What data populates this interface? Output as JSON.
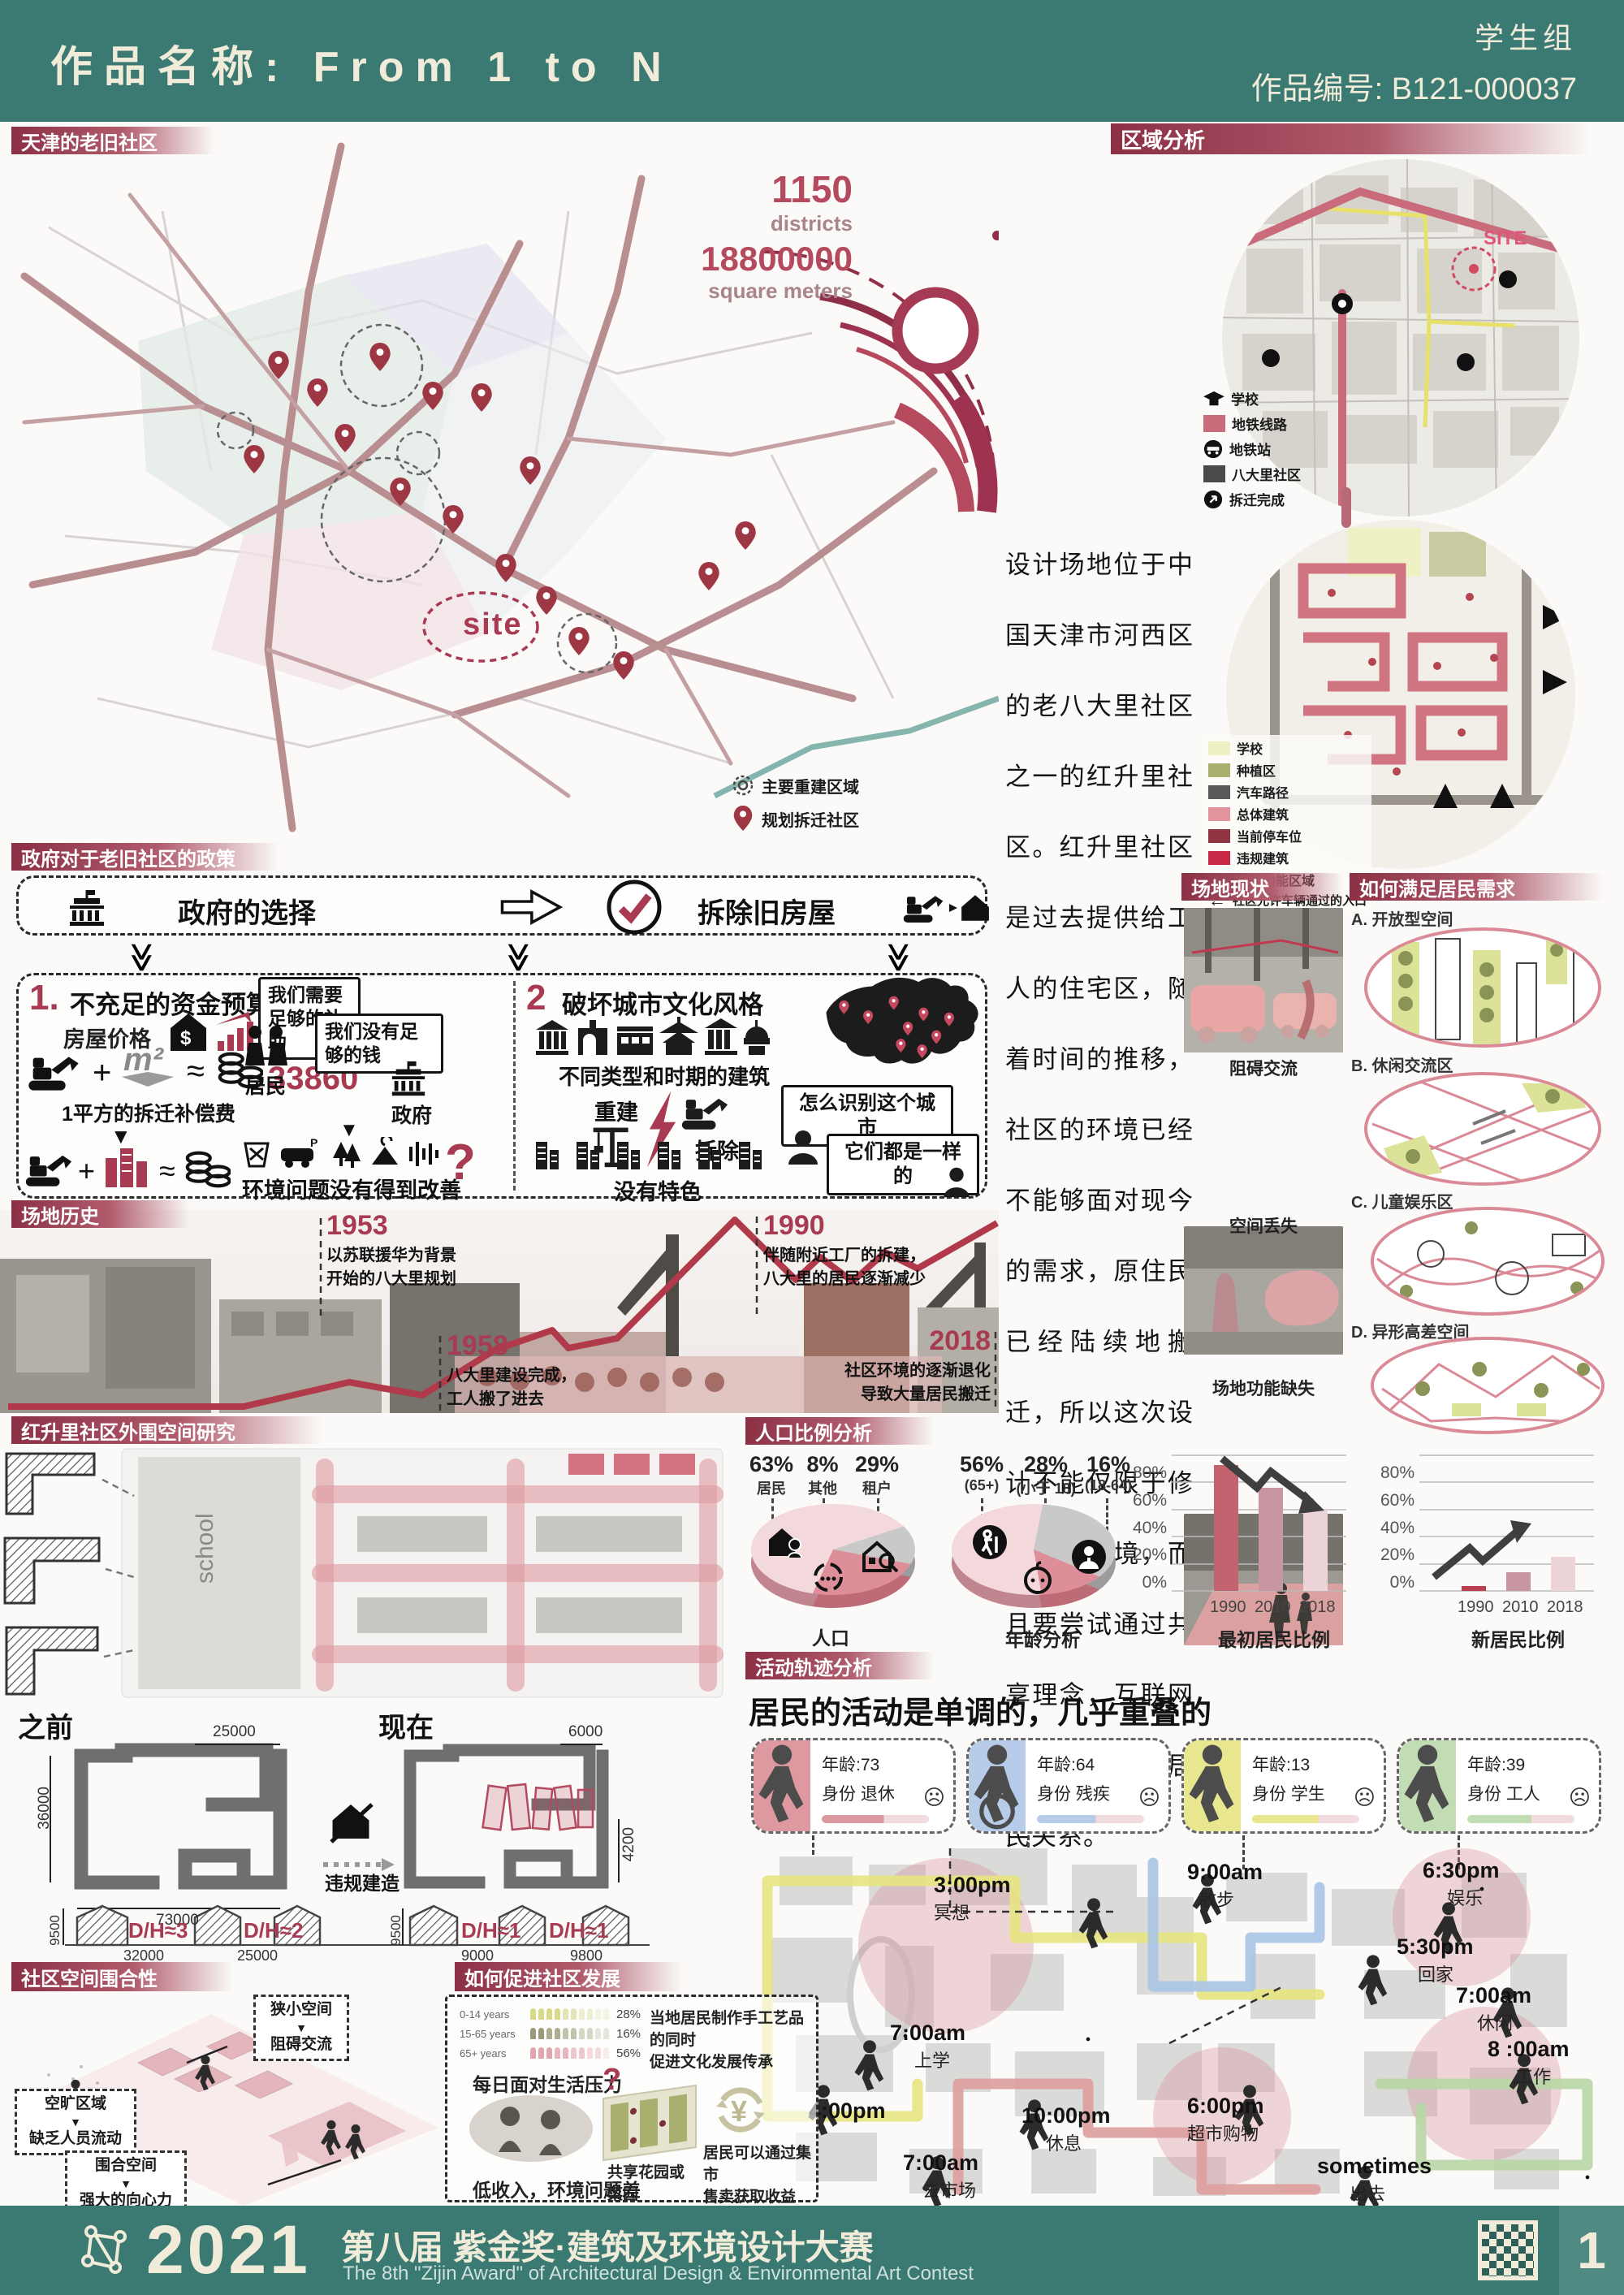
{
  "header": {
    "title": "作品名称: From 1 to N",
    "group": "学生组",
    "work_no": "作品编号: B121-000037"
  },
  "colors": {
    "teal": "#3a7a72",
    "maroon": "#a83a52",
    "accent_red": "#b5495e",
    "pink_light": "#e8c9ce"
  },
  "icons": {
    "down_triangle": "▼",
    "double_chevron": "≫",
    "sad_face": "☹",
    "left_arrow": "←",
    "tri_right": "▸"
  },
  "old_community": {
    "label": "天津的老旧社区",
    "stat1_value": "1150",
    "stat1_unit": "districts",
    "stat2_value": "18800000",
    "stat2_unit": "square meters",
    "base": "BASE",
    "site": "site",
    "legend": [
      {
        "label": "主要重建区域"
      },
      {
        "label": "规划拆迁社区"
      }
    ]
  },
  "region": {
    "label": "区域分析",
    "site_tag": "SITE",
    "legend1": [
      {
        "label": "学校"
      },
      {
        "label": "地铁线路"
      },
      {
        "label": "地铁站"
      },
      {
        "label": "八大里社区"
      },
      {
        "label": "拆迁完成"
      }
    ],
    "legend2": [
      {
        "label": "学校",
        "color": "#eff0c3"
      },
      {
        "label": "种植区",
        "color": "#a9b06f"
      },
      {
        "label": "汽车路径",
        "color": "#595959"
      },
      {
        "label": "总体建筑",
        "color": "#e1949c"
      },
      {
        "label": "当前停车位",
        "color": "#8f3642"
      },
      {
        "label": "违规建筑",
        "color": "#c62846"
      },
      {
        "label": "混合功能区域",
        "color": "#e4687f"
      }
    ],
    "entrance_note": "社区允许车辆通过的入口"
  },
  "intro": "设计场地位于中国天津市河西区的老八大里社区之一的红升里社区。红升里社区是过去提供给工人的住宅区，随着时间的推移，社区的环境已经不能够面对现今的需求，原住民已经陆续地搬迁，所以这次设计不能仅限于修复社区环境，而且要尝试通过共享理念，互联网的大背景重建居民关系。",
  "policy": {
    "label": "政府对于老旧社区的政策",
    "gov_choice": "政府的选择",
    "demolish": "拆除旧房屋",
    "p1_no": "1.",
    "p1_title": "不充足的资金预算",
    "house_price": "房屋价格",
    "plus": "+",
    "m2": "m²",
    "approx": "≈",
    "amount": "33860",
    "comp_note": "1平方的拆迁补偿费",
    "question": "?",
    "bubble_need": "我们需要足够的补助",
    "residents": "居民",
    "bubble_money": "我们没有足够的钱",
    "government": "政府",
    "env_note": "环境问题没有得到改善",
    "p2_no": "2",
    "p2_title": "破坏城市文化风格",
    "building_note": "不同类型和时期的建筑",
    "rebuild": "重建",
    "demolish2": "拆除",
    "no_feature": "没有特色",
    "bubble_city": "怎么识别这个城市",
    "bubble_same": "它们都是一样的"
  },
  "history": {
    "label": "场地历史",
    "events": [
      {
        "year": "1953",
        "line1": "以苏联援华为背景",
        "line2": "开始的八大里规划"
      },
      {
        "year": "1958",
        "line1": "八大里建设完成，",
        "line2": "工人搬了进去"
      },
      {
        "year": "1990",
        "line1": "伴随附近工厂的拆建，",
        "line2": "八大里的居民逐渐减少"
      },
      {
        "year": "2018",
        "line1": "社区环境的逐渐退化",
        "line2": "导致大量居民搬迁"
      }
    ]
  },
  "status": {
    "label": "场地现状",
    "captions": [
      "阻碍交流",
      "空间丢失",
      "场地功能缺失"
    ]
  },
  "needs": {
    "label": "如何满足居民需求",
    "items": [
      "A. 开放型空间",
      "B. 休闲交流区",
      "C. 儿童娱乐区",
      "D. 异形高差空间"
    ]
  },
  "outer": {
    "label": "红升里社区外围空间研究",
    "school": "school",
    "before": "之前",
    "now": "现在",
    "illegal": "违规建造",
    "b_h": "36000",
    "b_w_top": "25000",
    "b_w": "73000",
    "b_sec_h": "9500",
    "b_dh1": "D/H≈3",
    "b_dim1": "32000",
    "b_dh2": "D/H≈2",
    "b_dim2": "25000",
    "n_w_top": "6000",
    "n_h_right": "4200",
    "n_sec_h": "9500",
    "n_dh1": "D/H≈1",
    "n_dim1": "9000",
    "n_dh2": "D/H≈1",
    "n_dim2": "9800"
  },
  "demo": {
    "label": "人口比例分析",
    "pie1_title": "人口",
    "pie1": [
      {
        "pct": "63%",
        "label": "居民"
      },
      {
        "pct": "8%",
        "label": "其他"
      },
      {
        "pct": "29%",
        "label": "租户"
      }
    ],
    "pie2_title": "年龄分析",
    "pie2": [
      {
        "pct": "56%",
        "label": "(65+)"
      },
      {
        "pct": "28%",
        "label": "(小于 18)"
      },
      {
        "pct": "16%",
        "label": "(18-64)"
      }
    ],
    "axis": [
      "80%",
      "60%",
      "40%",
      "20%",
      "0%"
    ],
    "years": [
      "1990",
      "2010",
      "2018"
    ],
    "bar1_title": "最初居民比例",
    "bar2_title": "新居民比例"
  },
  "chart_data": [
    {
      "type": "pie",
      "title": "人口",
      "labels": [
        "居民",
        "其他",
        "租户"
      ],
      "values": [
        63,
        8,
        29
      ]
    },
    {
      "type": "pie",
      "title": "年龄分析",
      "labels": [
        "65+",
        "小于18",
        "18-64"
      ],
      "values": [
        56,
        28,
        16
      ]
    },
    {
      "type": "bar",
      "title": "最初居民比例",
      "categories": [
        "1990",
        "2010",
        "2018"
      ],
      "values": [
        93,
        76,
        60
      ],
      "ylabel": "%",
      "ylim": [
        0,
        100
      ],
      "trend": "down"
    },
    {
      "type": "bar",
      "title": "新居民比例",
      "categories": [
        "1990",
        "2010",
        "2018"
      ],
      "values": [
        3,
        14,
        25
      ],
      "ylabel": "%",
      "ylim": [
        0,
        100
      ],
      "trend": "up"
    },
    {
      "type": "bar",
      "title": "年龄结构 pictograph",
      "categories": [
        "0-14 years",
        "15-65 years",
        "65+ years"
      ],
      "values": [
        28,
        16,
        56
      ],
      "ylabel": "%"
    }
  ],
  "activity": {
    "label": "活动轨迹分析",
    "headline": "居民的活动是单调的，几乎重叠的",
    "personas": [
      {
        "age": "年龄:73",
        "role": "身份 退休",
        "mood": "孤独",
        "color": "#dd98a0"
      },
      {
        "age": "年龄:64",
        "role": "身份 残疾",
        "mood": "孤独",
        "color": "#b7cce9"
      },
      {
        "age": "年龄:13",
        "role": "身份 学生",
        "mood": "无聊",
        "color": "#e9e690"
      },
      {
        "age": "年龄:39",
        "role": "身份 工人",
        "mood": "无聊",
        "color": "#c2dcb4"
      }
    ],
    "events": [
      {
        "time": "3:00pm",
        "act": "冥想"
      },
      {
        "time": "9:00am",
        "act": "散步"
      },
      {
        "time": "6:30pm",
        "act": "娱乐"
      },
      {
        "time": "5:30pm",
        "act": "回家"
      },
      {
        "time": "7:00am",
        "act": "休闲"
      },
      {
        "time": "7:00am",
        "act": "上学"
      },
      {
        "time": "8 :00am",
        "act": "工作"
      },
      {
        "time": "4:00pm",
        "act": ""
      },
      {
        "time": "10:00pm",
        "act": "休息"
      },
      {
        "time": "6:00pm",
        "act": "超市购物"
      },
      {
        "time": "7:00am",
        "act": "去市场"
      },
      {
        "time": "sometimes",
        "act": "出去"
      }
    ]
  },
  "enclosure": {
    "label": "社区空间围合性",
    "pairs": [
      {
        "cause": "狭小空间",
        "effect": "阻碍交流"
      },
      {
        "cause": "空旷区域",
        "effect": "缺乏人员流动"
      },
      {
        "cause": "围合空间",
        "effect": "强大的向心力"
      }
    ]
  },
  "develop": {
    "label": "如何促进社区发展",
    "picto": [
      {
        "label": "0-14 years",
        "pct": "28%"
      },
      {
        "label": "15-65 years",
        "pct": "16%"
      },
      {
        "label": "65+ years",
        "pct": "56%"
      }
    ],
    "pressure": "每日面对生活压力",
    "question": "?",
    "low_income": "低收入，环境问题差",
    "craft1": "当地居民制作手工艺品的同时",
    "craft2": "促进文化发展传承",
    "market1": "居民可以通过集市",
    "market2": "售卖获取收益",
    "garden1": "共享花园或菜园",
    "garden2": "自给自足",
    "yuan": "¥"
  },
  "footer": {
    "year": "2021",
    "title": "第八届 紫金奖·建筑及环境设计大赛",
    "subtitle": "The 8th \"Zijin Award\" of Architectural Design & Environmental Art Contest",
    "page": "1"
  }
}
